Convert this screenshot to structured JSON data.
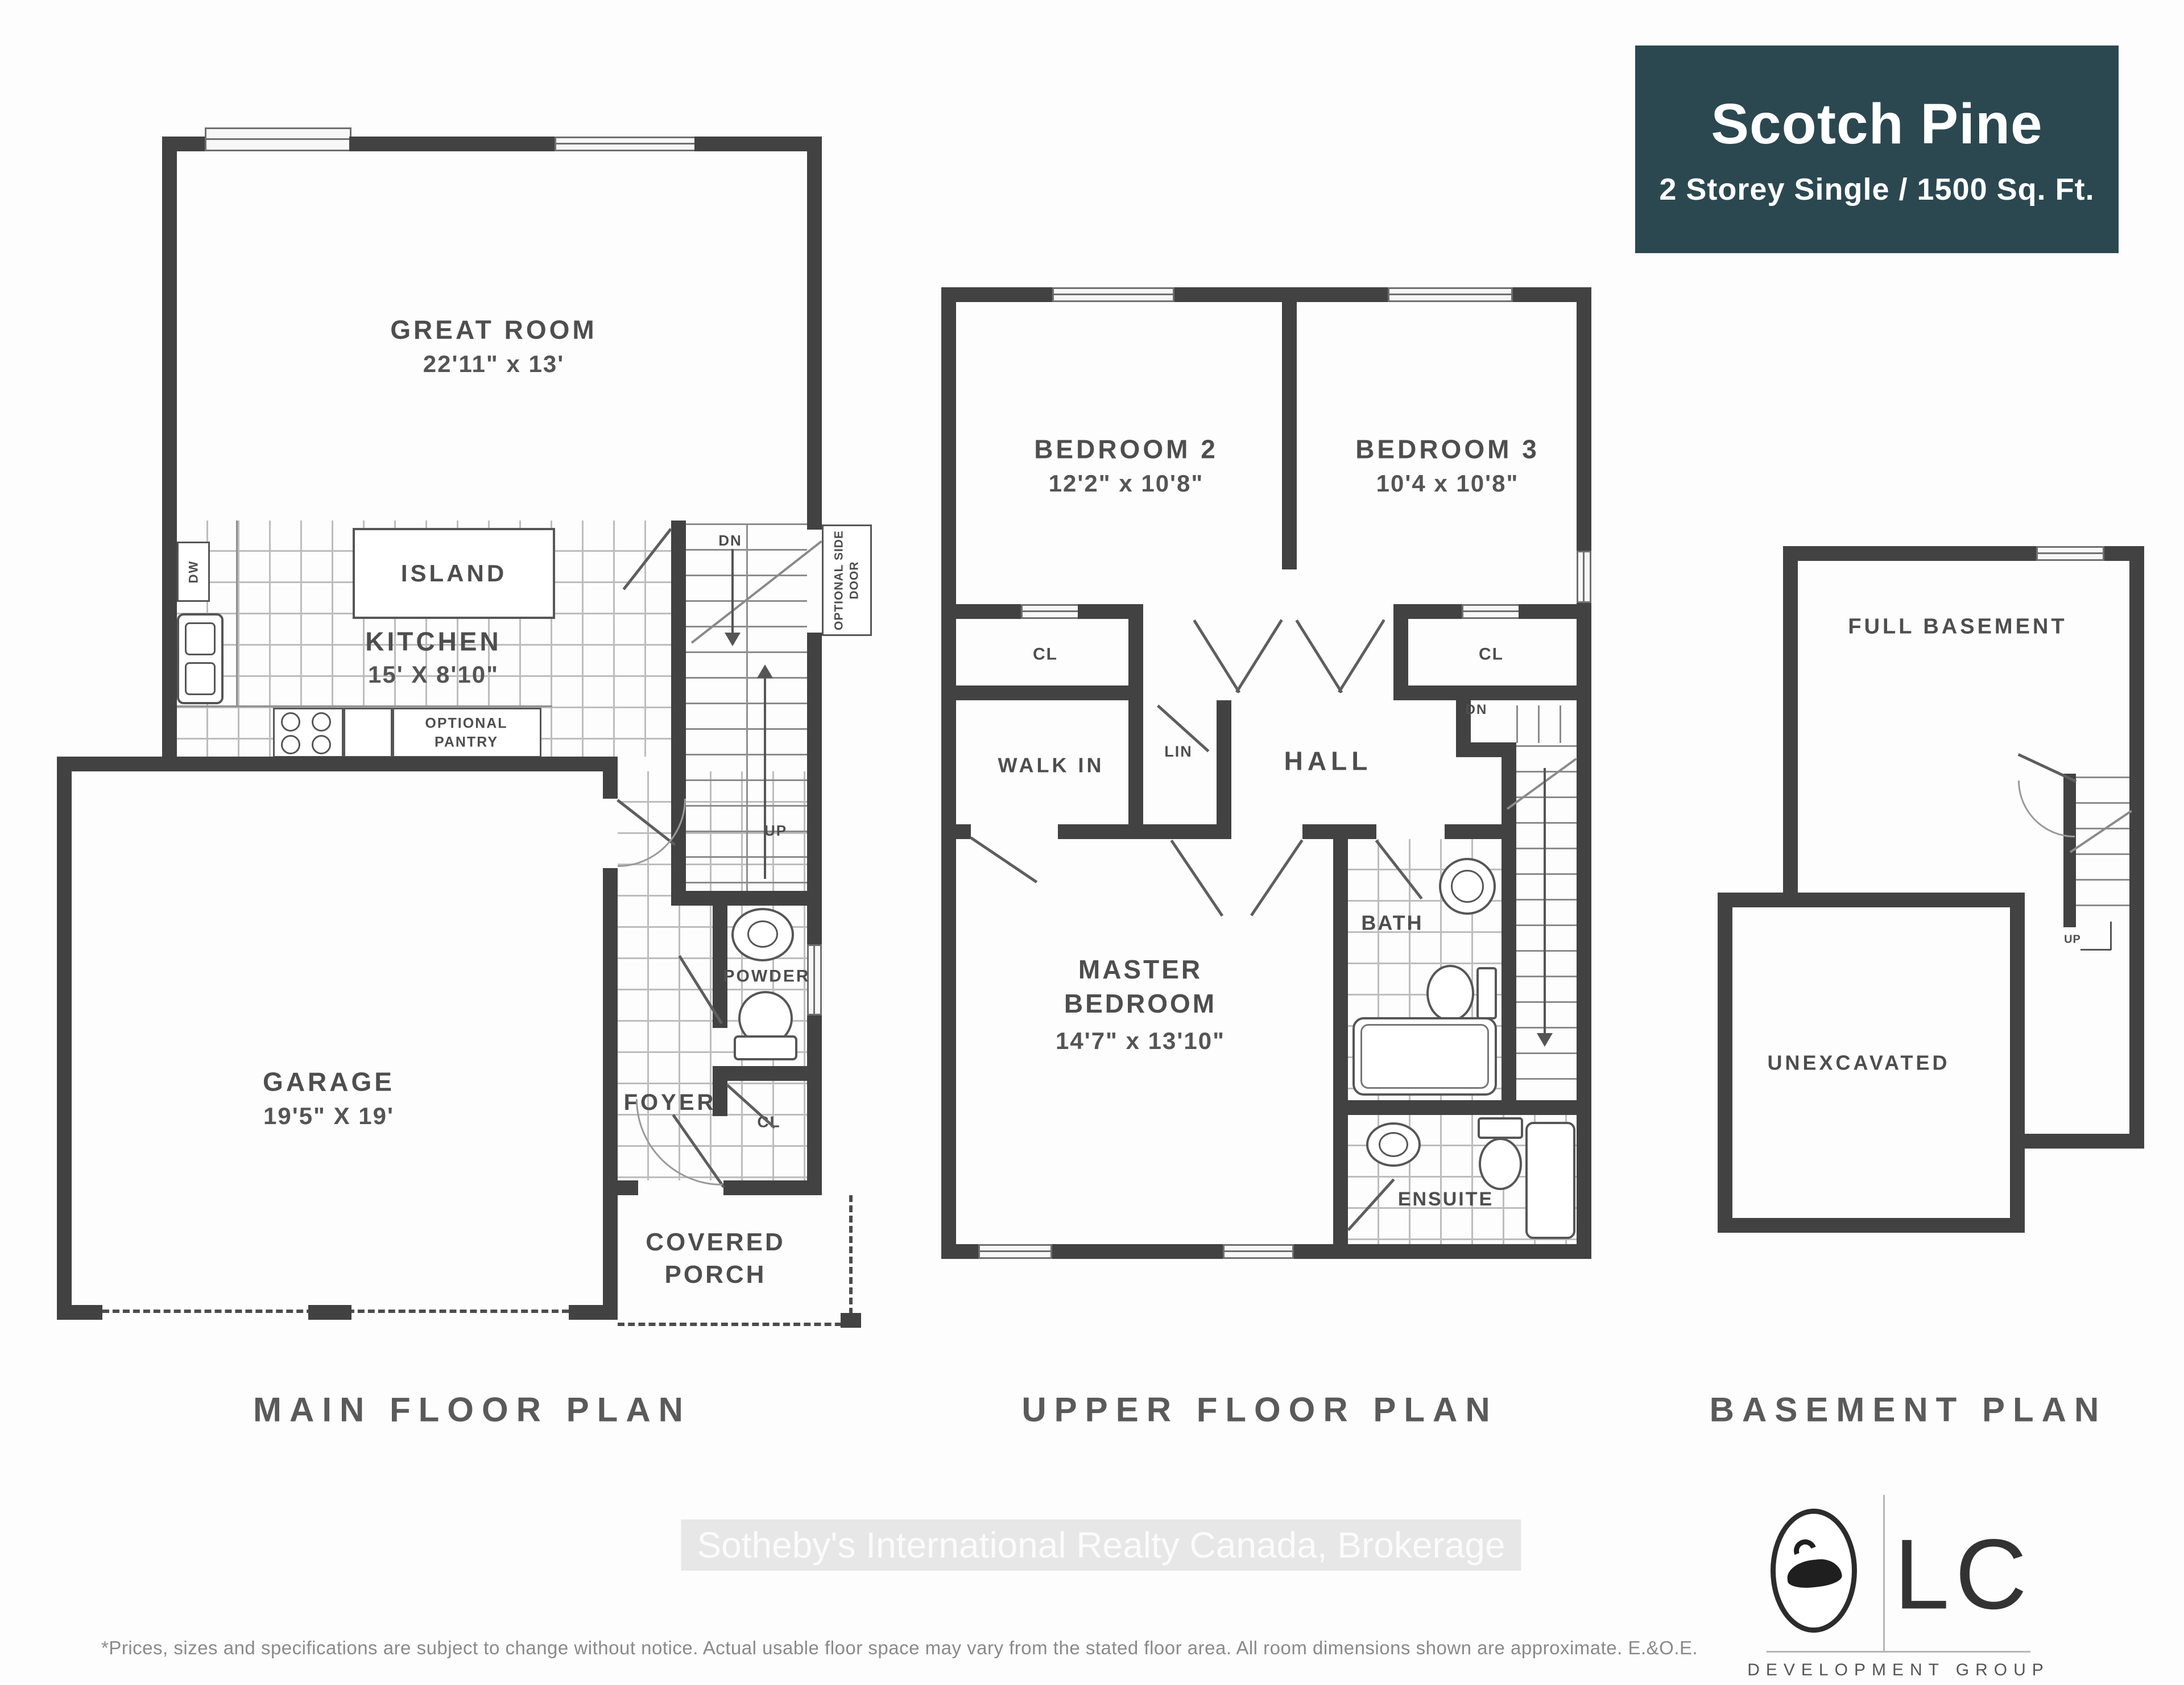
{
  "title_card": {
    "title": "Scotch Pine",
    "subtitle": "2 Storey Single / 1500 Sq. Ft."
  },
  "plan_titles": {
    "main": "MAIN FLOOR PLAN",
    "upper": "UPPER FLOOR PLAN",
    "basement": "BASEMENT PLAN"
  },
  "main_floor": {
    "great_room": {
      "name": "GREAT ROOM",
      "dims": "22'11\" x 13'"
    },
    "kitchen": {
      "name": "KITCHEN",
      "dims": "15' X 8'10\""
    },
    "island": "ISLAND",
    "optional_pantry": "OPTIONAL PANTRY",
    "dw": "DW",
    "dn": "DN",
    "up": "UP",
    "optional_side_door": "OPTIONAL SIDE DOOR",
    "garage": {
      "name": "GARAGE",
      "dims": "19'5\" X 19'"
    },
    "foyer": "FOYER",
    "powder": "POWDER",
    "closet": "CL",
    "covered_porch": "COVERED PORCH"
  },
  "upper_floor": {
    "bedroom2": {
      "name": "BEDROOM 2",
      "dims": "12'2\" x 10'8\""
    },
    "bedroom3": {
      "name": "BEDROOM 3",
      "dims": "10'4 x 10'8\""
    },
    "closet": "CL",
    "walk_in": "WALK IN",
    "linen": "LIN",
    "hall": "HALL",
    "dn": "DN",
    "master": {
      "name": "MASTER BEDROOM",
      "dims": "14'7\" x 13'10\""
    },
    "bath": "BATH",
    "ensuite": "ENSUITE"
  },
  "basement": {
    "full_basement": "FULL BASEMENT",
    "unexcavated": "UNEXCAVATED",
    "up": "UP"
  },
  "watermark": "Sotheby's International Realty Canada, Brokerage",
  "disclaimer": "*Prices, sizes and specifications are subject to change without notice. Actual usable floor space may vary from the stated floor area. All room dimensions shown are approximate. E.&O.E.",
  "logo": {
    "monogram": "LC",
    "subtext": "DEVELOPMENT GROUP"
  },
  "colors": {
    "accent_teal": "#2b4851",
    "wall": "#424242",
    "label": "#4e4e4e"
  }
}
